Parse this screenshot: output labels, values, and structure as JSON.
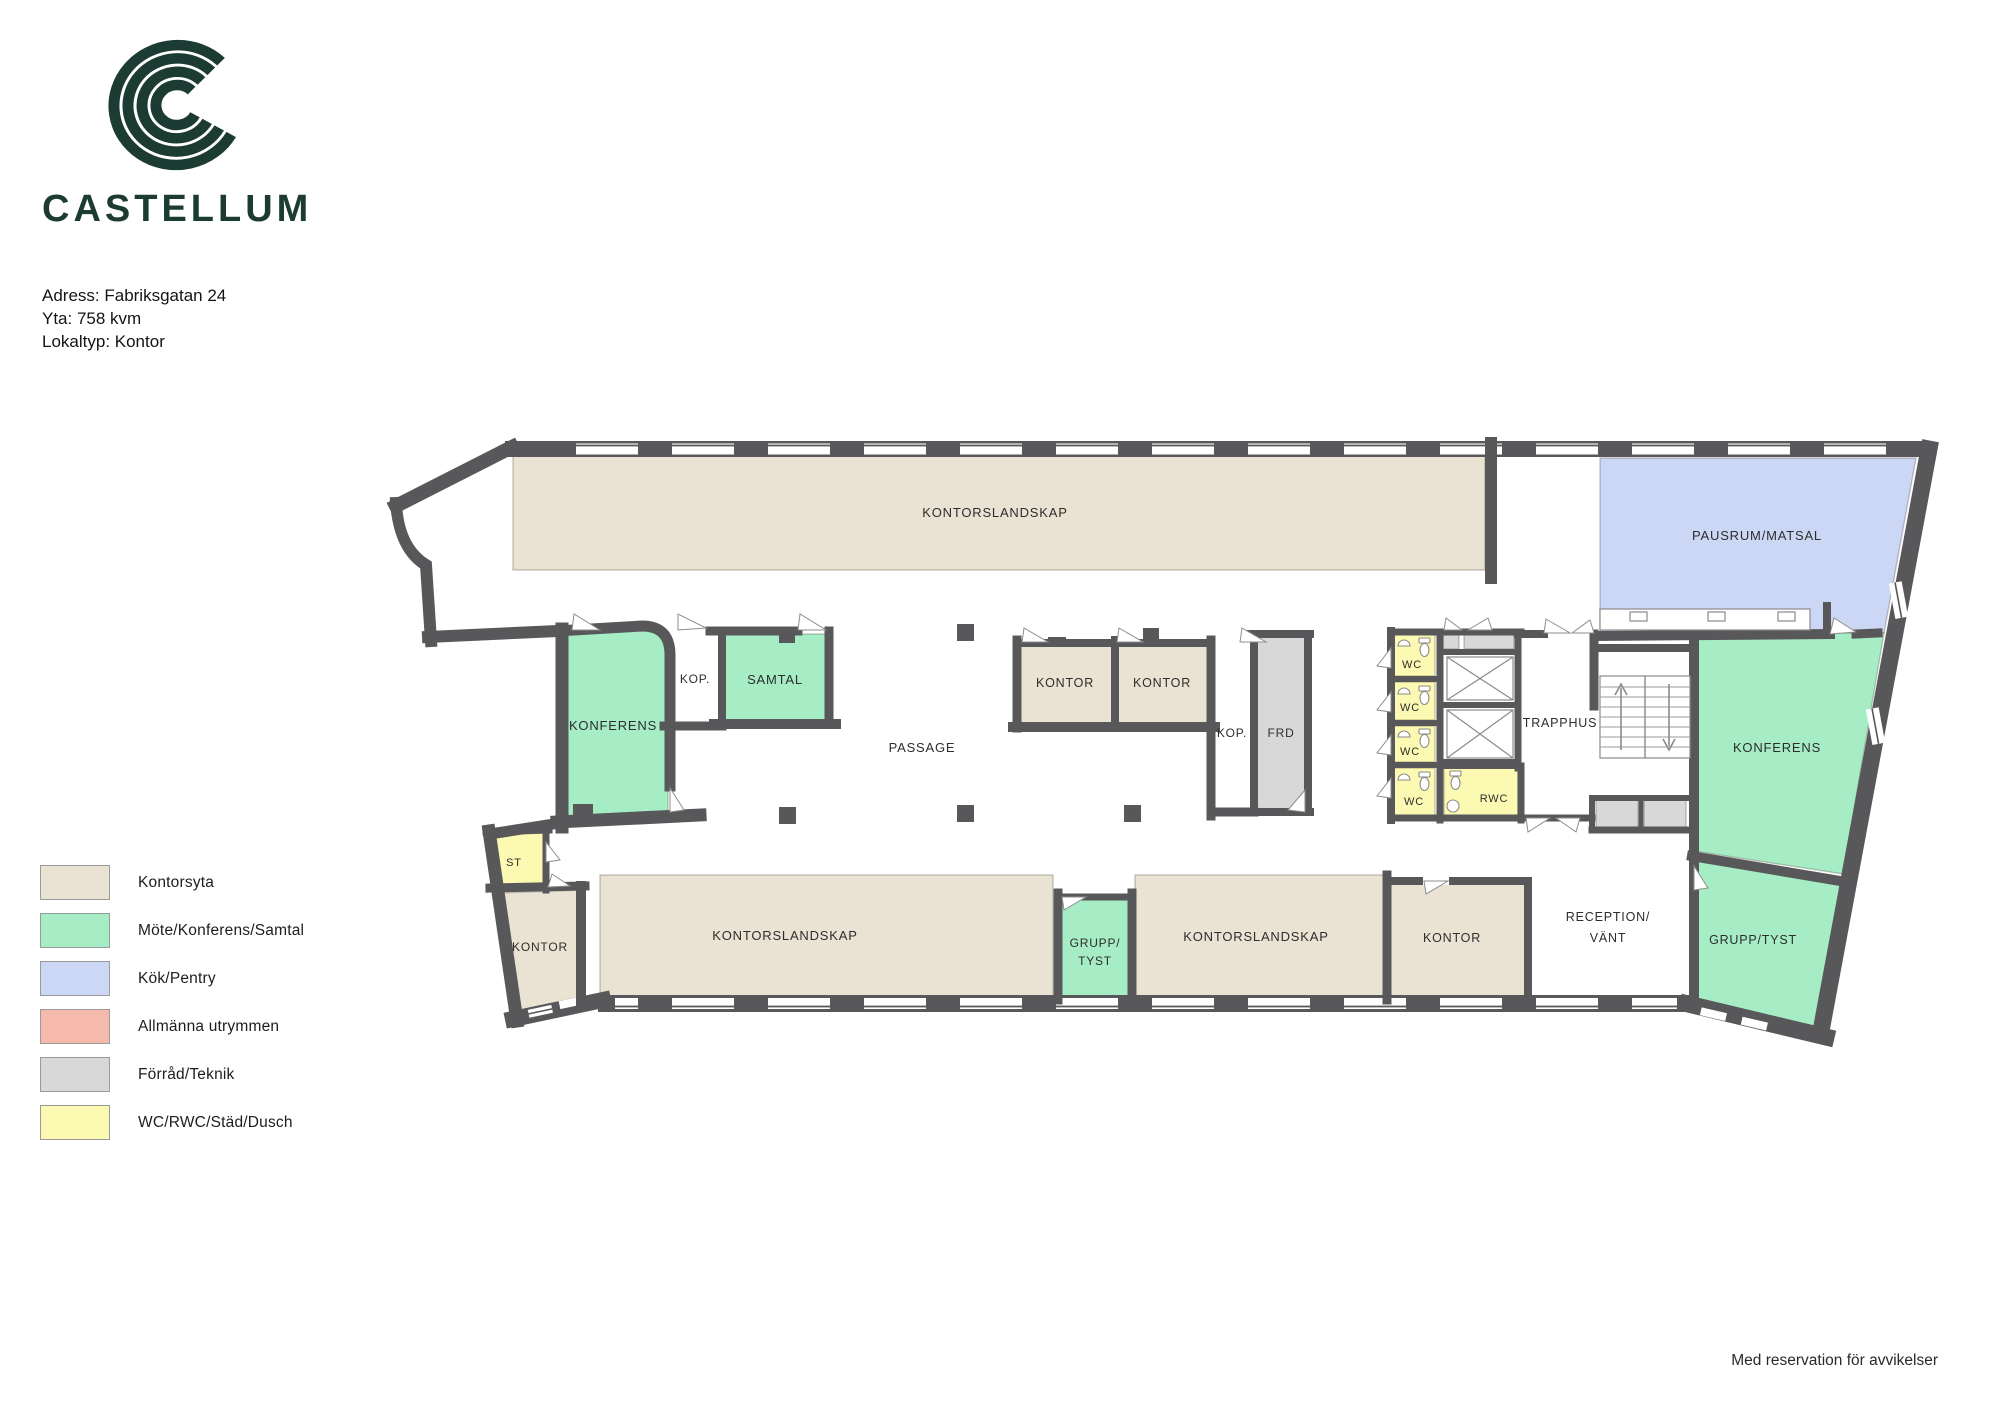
{
  "header": {
    "brand": "CASTELLUM",
    "address": "Adress: Fabriksgatan 24",
    "area": "Yta: 758 kvm",
    "local_type": "Lokaltyp: Kontor"
  },
  "legend": {
    "items": [
      {
        "label": "Kontorsyta",
        "color": "#eae3d3"
      },
      {
        "label": "Möte/Konferens/Samtal",
        "color": "#a6edc6"
      },
      {
        "label": "Kök/Pentry",
        "color": "#ccd6f5"
      },
      {
        "label": "Allmänna utrymmen",
        "color": "#f6baac"
      },
      {
        "label": "Förråd/Teknik",
        "color": "#d8d8d8"
      },
      {
        "label": "WC/RWC/Städ/Dusch",
        "color": "#fcf9b2"
      }
    ]
  },
  "plan": {
    "rooms": {
      "kontorslandskap_top": "KONTORSLANDSKAP",
      "pausrum": "PAUSRUM/MATSAL",
      "kop_left": "KOP.",
      "samtal": "SAMTAL",
      "konferens_left": "KONFERENS",
      "passage": "PASSAGE",
      "kontor_mid_1": "KONTOR",
      "kontor_mid_2": "KONTOR",
      "kop_right": "KOP.",
      "frd": "FRD",
      "wc_1": "WC",
      "wc_2": "WC",
      "wc_3": "WC",
      "wc_4": "WC",
      "rwc": "RWC",
      "trapphus": "TRAPPHUS",
      "konferens_right": "KONFERENS",
      "st": "ST",
      "kontor_bottom_left": "KONTOR",
      "kontorslandskap_b1": "KONTORSLANDSKAP",
      "grupp_tyst_mid_l1": "GRUPP/",
      "grupp_tyst_mid_l2": "TYST",
      "kontorslandskap_b2": "KONTORSLANDSKAP",
      "kontor_bottom_right": "KONTOR",
      "reception_l1": "RECEPTION/",
      "reception_l2": "VÄNT",
      "grupp_tyst_right": "GRUPP/TYST"
    }
  },
  "colors": {
    "wall": "#58585a",
    "office": "#eae3d3",
    "meeting": "#a6edc6",
    "kitchen": "#ccd6f5",
    "common": "#f6baac",
    "storage": "#d8d8d8",
    "wc": "#fcf9b2",
    "brand_green": "#1c3b33"
  },
  "footer": {
    "disclaimer": "Med reservation för avvikelser"
  }
}
